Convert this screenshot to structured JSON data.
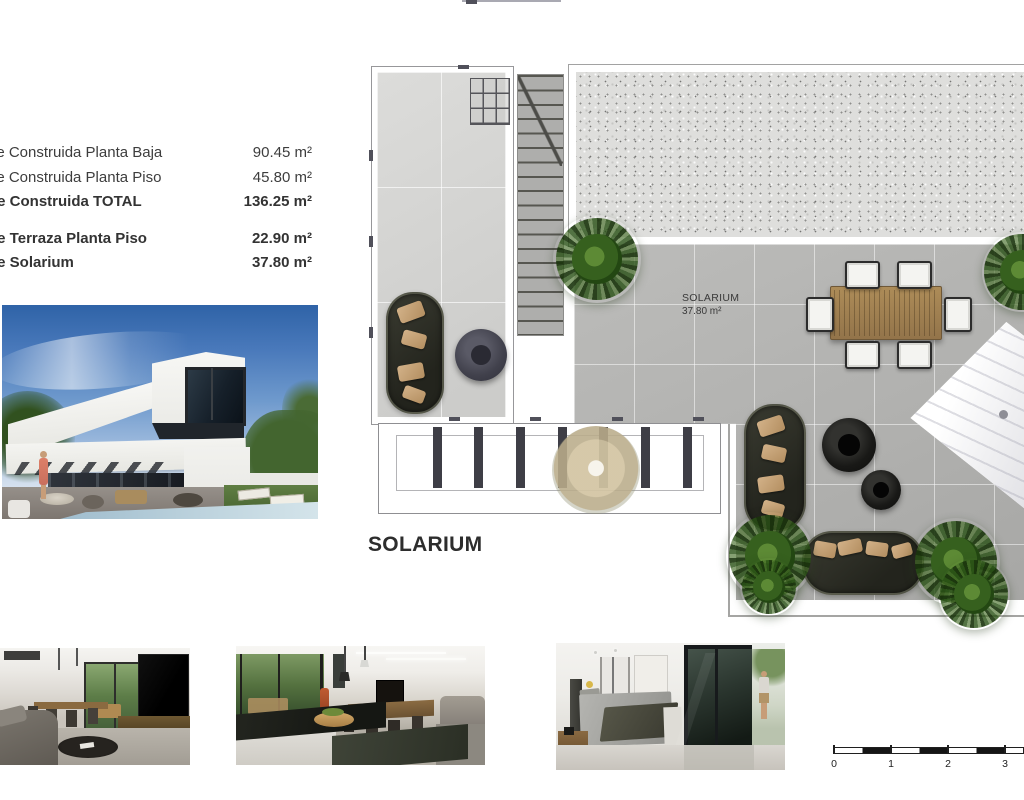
{
  "document": {
    "surface_table": {
      "rows": [
        {
          "label": "ie Construida Planta Baja",
          "value": "90.45 m²"
        },
        {
          "label": "ie Construida Planta Piso",
          "value": "45.80 m²"
        },
        {
          "label": "ie Construida TOTAL",
          "value": "136.25 m²"
        },
        {
          "label": "ie Terraza Planta Piso",
          "value": "22.90 m²"
        },
        {
          "label": "ie Solarium",
          "value": "37.80 m²"
        }
      ]
    },
    "plan": {
      "room_label_title": "SOLARIUM",
      "room_label_area": "37.80 m²",
      "caption": "SOLARIUM"
    },
    "scale_bar": {
      "labels": [
        "0",
        "1",
        "2",
        "3"
      ]
    },
    "colors": {
      "tile_light": "#d6d6d4",
      "tile_solarium": "#b3b3b1",
      "gravel_base": "#dededc",
      "plant_green": "#36601e",
      "sofa_dark": "#2c2d25",
      "pillow_tan": "#c9a97c",
      "wood_table": "#a5854f",
      "sky_blue": "#4878ba",
      "pool_blue": "#b7cedd"
    }
  }
}
